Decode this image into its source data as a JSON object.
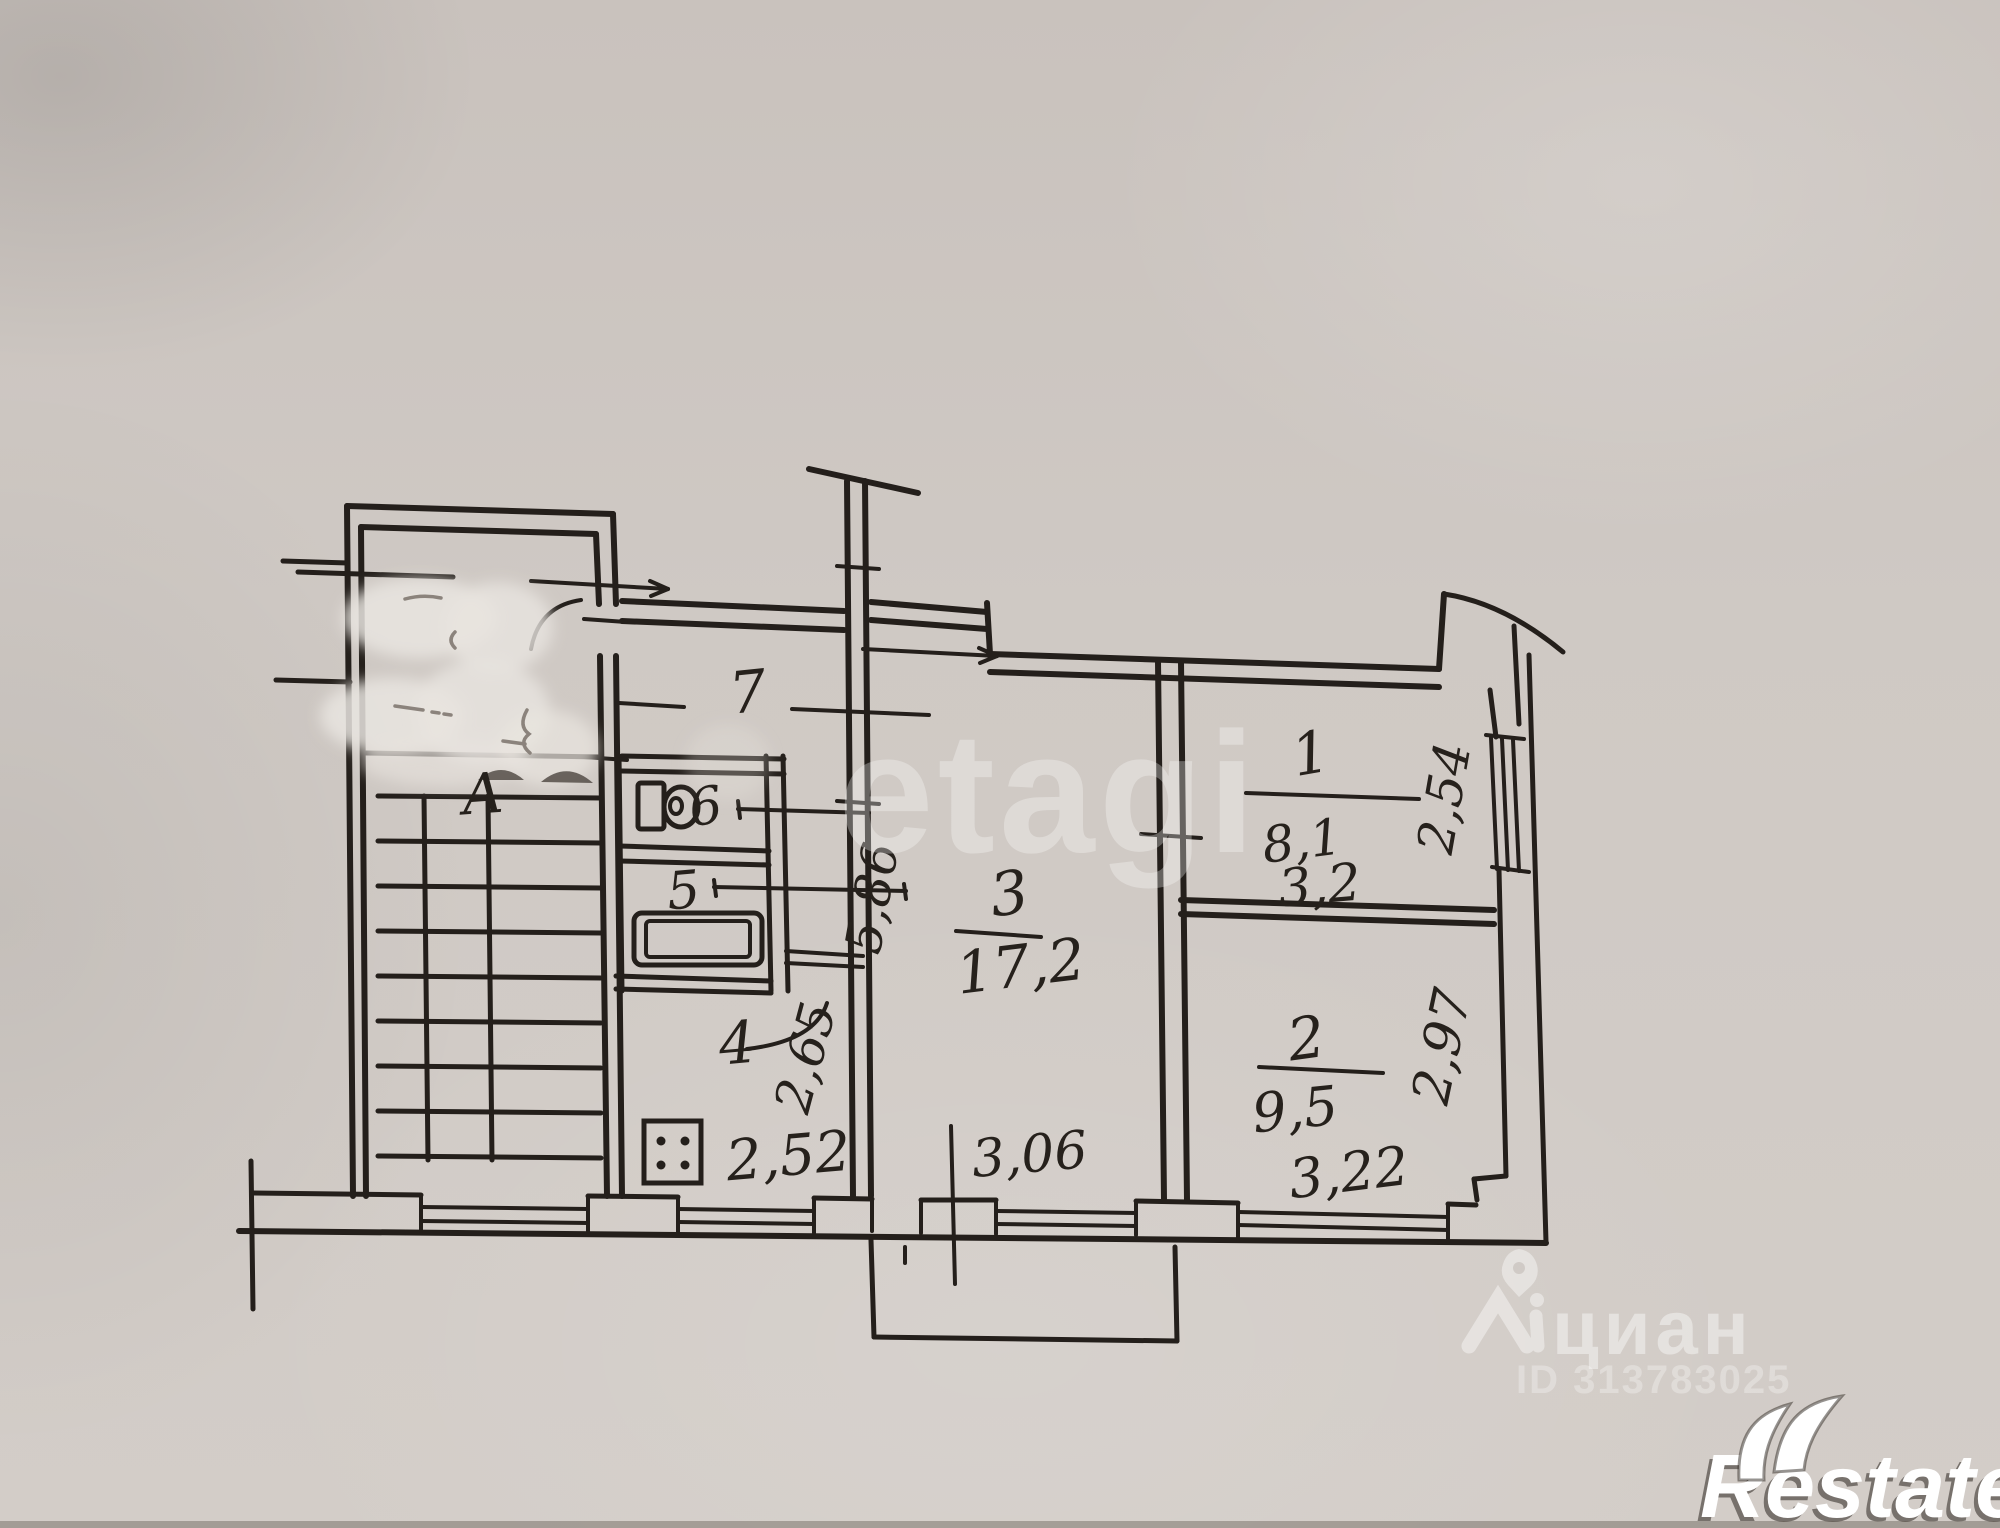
{
  "watermarks": {
    "etagi": "etagi",
    "cian_name": "циан",
    "cian_id": "ID 313783025",
    "restate_name": "Restate"
  },
  "plan": {
    "stairwell_label": "А",
    "rooms": [
      {
        "id": "1",
        "area": "8,1",
        "width": "3,2",
        "depth": "2,54"
      },
      {
        "id": "2",
        "area": "9,5",
        "width": "3,22",
        "depth": "2,97"
      },
      {
        "id": "3",
        "area": "17,2",
        "width": "3,06",
        "depth": "5,86"
      },
      {
        "id": "4",
        "width": "2,52",
        "depth": "2,65"
      },
      {
        "id": "5"
      },
      {
        "id": "6"
      },
      {
        "id": "7"
      }
    ]
  },
  "colors": {
    "paper": "#cfc9c4",
    "ink": "#241f1b",
    "watermark_white": "#ffffff"
  }
}
